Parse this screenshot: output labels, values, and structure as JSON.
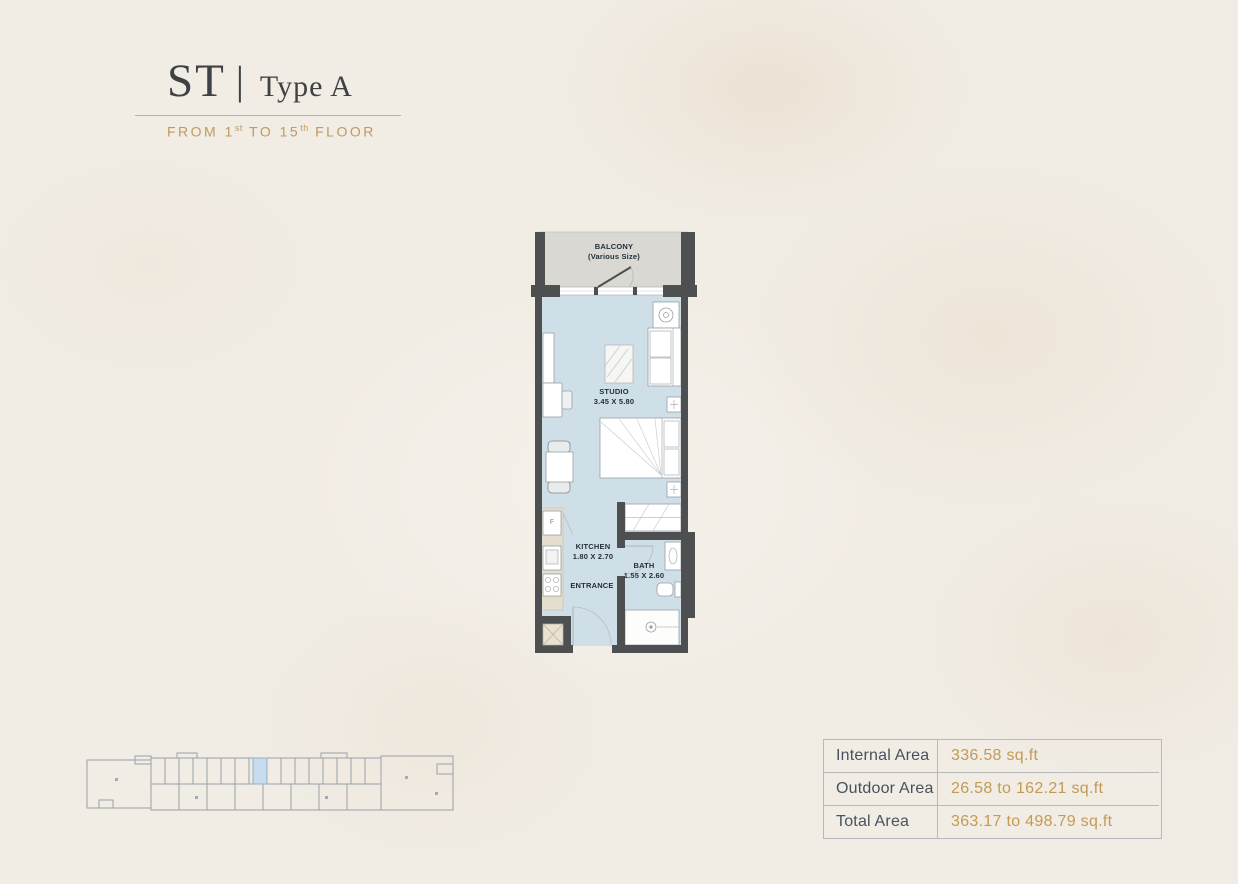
{
  "header": {
    "code": "ST",
    "separator": "|",
    "type_label": "Type A",
    "subtitle": {
      "part1": "FROM 1",
      "sup1": "st",
      "part2": " TO 15",
      "sup2": "th",
      "part3": " FLOOR"
    }
  },
  "plan": {
    "balcony_title": "BALCONY",
    "balcony_subtitle": "(Various Size)",
    "studio_title": "STUDIO",
    "studio_dims": "3.45 X 5.80",
    "kitchen_title": "KITCHEN",
    "kitchen_dims": "1.80 X 2.70",
    "bath_title": "BATH",
    "bath_dims": "1.55 X 2.60",
    "entrance_title": "ENTRANCE",
    "fridge_label": "F"
  },
  "area_table": {
    "rows": [
      {
        "label": "Internal Area",
        "value": "336.58 sq.ft"
      },
      {
        "label": "Outdoor Area",
        "value": "26.58 to 162.21 sq.ft"
      },
      {
        "label": "Total Area",
        "value": "363.17 to 498.79 sq.ft"
      }
    ]
  },
  "colors": {
    "accent_gold": "#bf9a62",
    "title_charcoal": "#3e4245",
    "table_label": "#48525d",
    "table_value": "#c39a58",
    "wall": "#4d4f50",
    "floor_blue": "#cfdfe8",
    "balcony_gray": "#d9d8d2",
    "counter_beige": "#e5ddcd",
    "keyplan_highlight": "#c7dded"
  }
}
